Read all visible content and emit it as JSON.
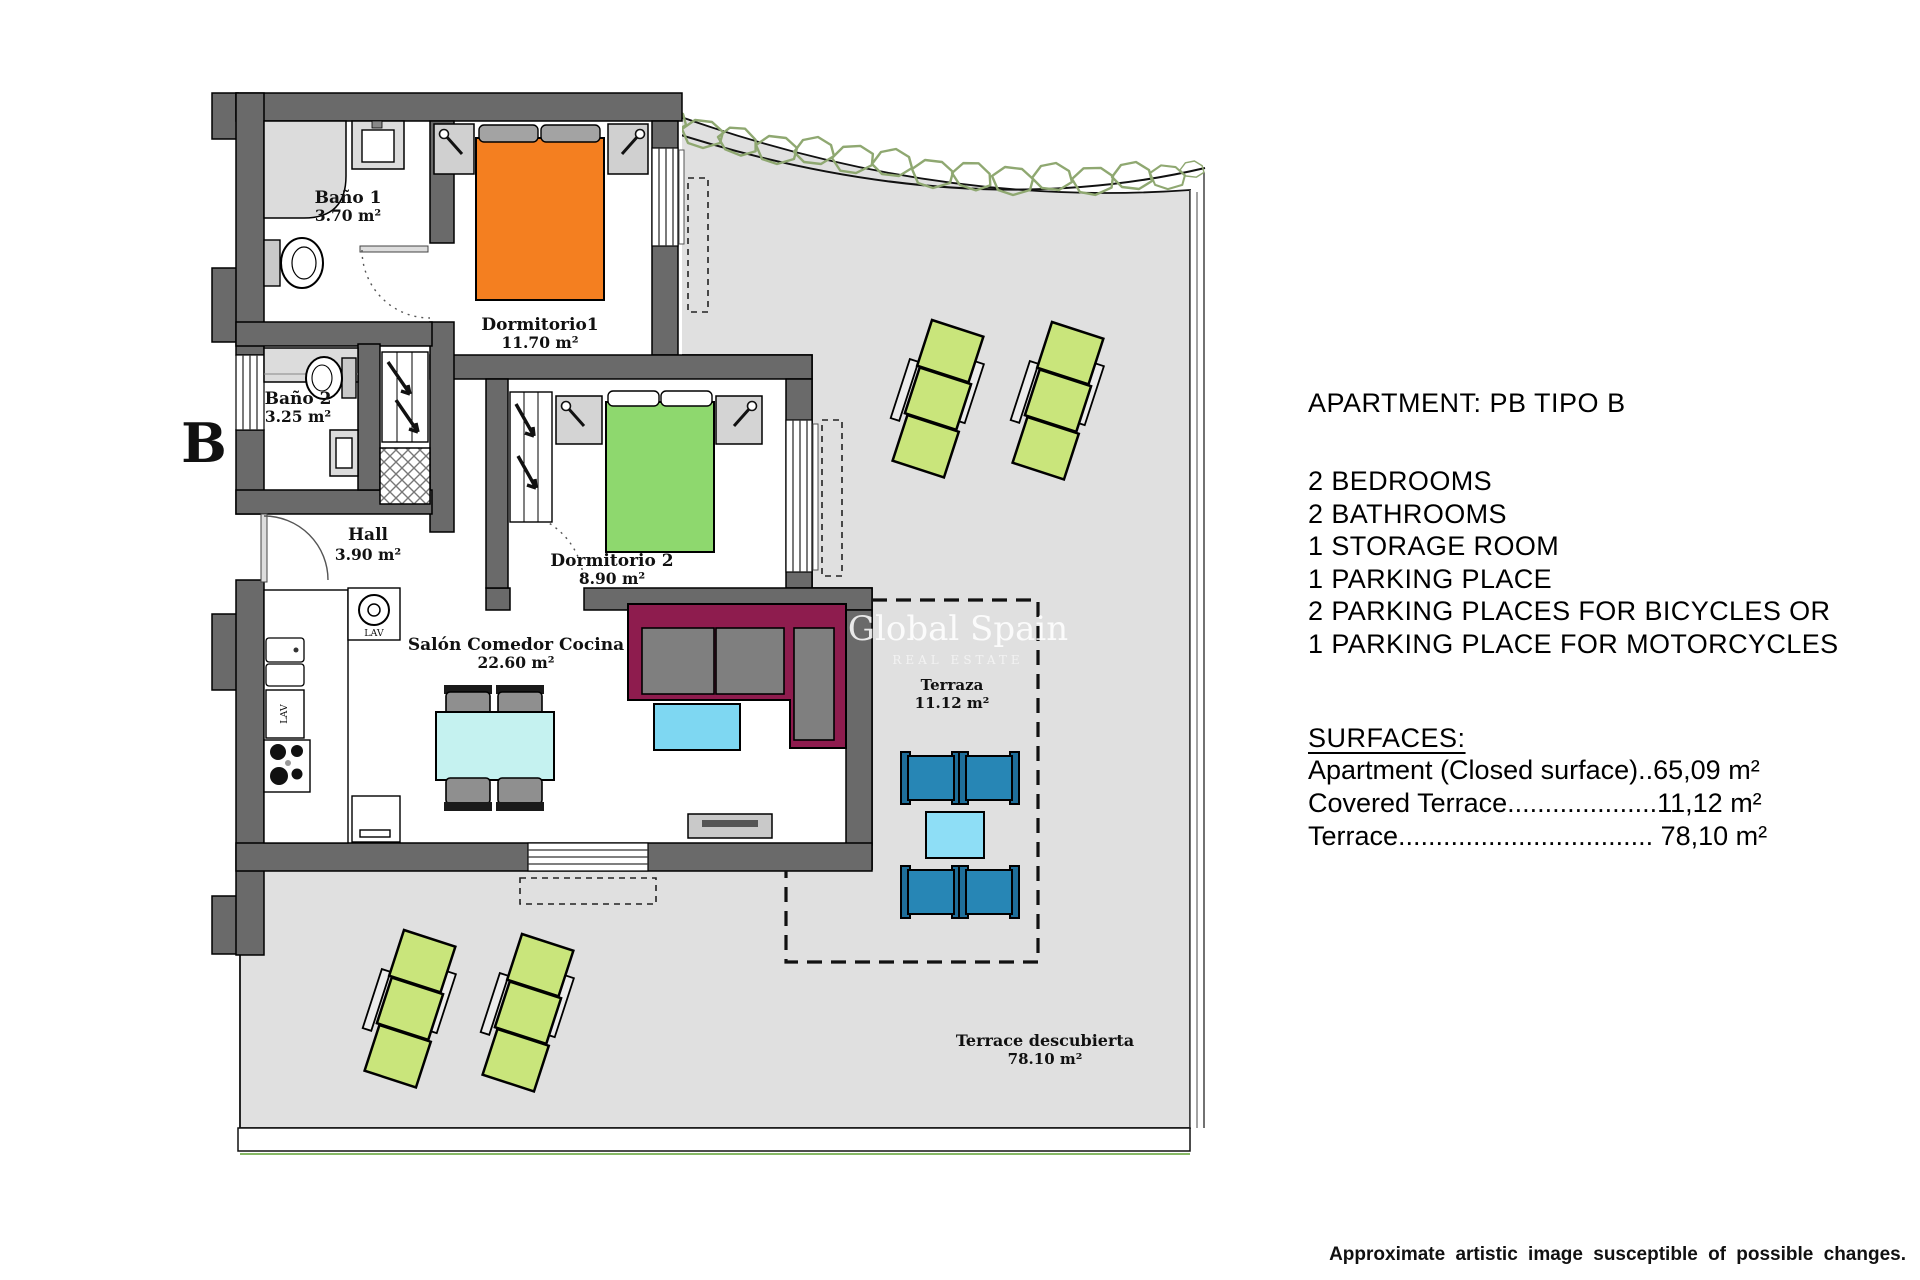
{
  "panel": {
    "title": "APARTMENT: PB TIPO B",
    "features": [
      "2 BEDROOMS",
      "2 BATHROOMS",
      "1 STORAGE ROOM",
      "1 PARKING PLACE",
      "2 PARKING PLACES FOR BICYCLES OR",
      "1 PARKING PLACE FOR MOTORCYCLES"
    ],
    "surfaces_heading": "SURFACES:",
    "surfaces": [
      "Apartment (Closed surface)..65,09 m²",
      "Covered Terrace....................11,12 m²",
      "Terrace.................................. 78,10 m²"
    ]
  },
  "disclaimer": "Approximate artistic image susceptible of possible changes.",
  "plan": {
    "block_letter": "B",
    "watermark_line1": "Global Spain",
    "watermark_line2": "REAL ESTATE",
    "rooms": {
      "bano1": {
        "name": "Baño 1",
        "area": "3.70 m²"
      },
      "bano2": {
        "name": "Baño 2",
        "area": "3.25 m²"
      },
      "hall": {
        "name": "Hall",
        "area": "3.90 m²"
      },
      "dorm1": {
        "name": "Dormitorio1",
        "area": "11.70 m²"
      },
      "dorm2": {
        "name": "Dormitorio 2",
        "area": "8.90 m²"
      },
      "salon": {
        "name": "Salón Comedor Cocina",
        "area": "22.60 m²"
      },
      "terraza": {
        "name": "Terraza",
        "area": "11.12 m²"
      },
      "terrace_open": {
        "name": "Terrace descubierta",
        "area": "78.10 m²"
      }
    },
    "kitchen_labels": {
      "washer": "LAV",
      "dishwasher": "LAV"
    },
    "colors": {
      "terrace_fill": "#e0e0e0",
      "wall": "#6a6a6a",
      "bed1": "#f47f20",
      "bed2": "#8ed86e",
      "lounger": "#c9e57b",
      "chair_blue": "#2786b5",
      "small_table": "#8edef6",
      "coffee_table": "#7ed7f2",
      "dining_table": "#c5f2f0",
      "sofa": "#8e1c4e",
      "hedge": "#8fa871"
    }
  }
}
